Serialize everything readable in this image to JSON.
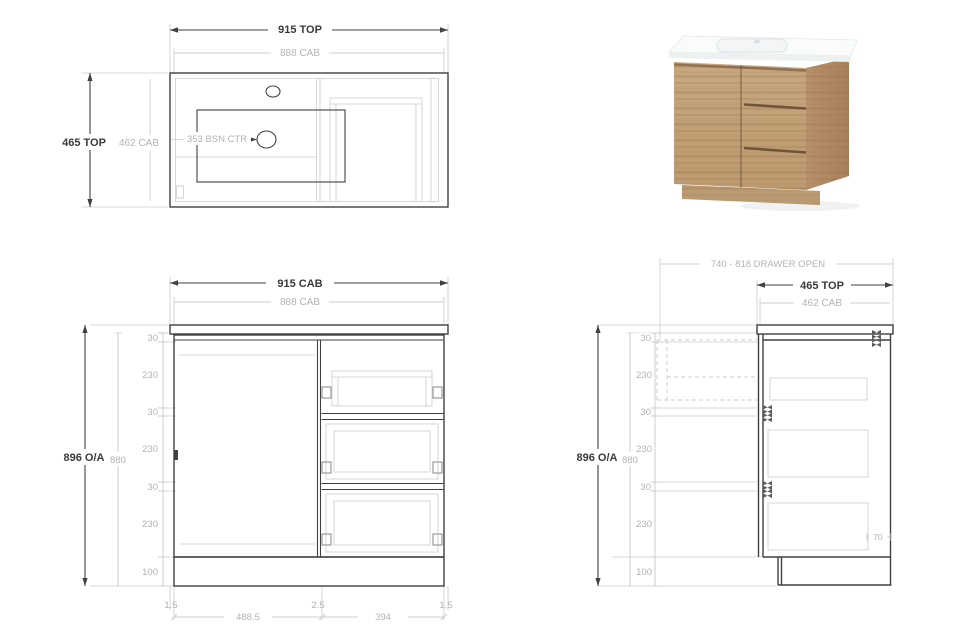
{
  "colors": {
    "line-dark": "#404040",
    "line-gray": "#cccccc",
    "text-dark": "#3a3a3a",
    "text-gray": "#b3b3b3",
    "wood": "#c8a77e",
    "wood-side": "#b18a62",
    "wood-groove": "#6f543a",
    "ceramic": "#fafbfb"
  },
  "top_view": {
    "width_top": "915 TOP",
    "width_cab": "888 CAB",
    "depth_top": "465 TOP",
    "depth_cab": "462 CAB",
    "basin_centre": "353 BSN CTR"
  },
  "front_view": {
    "width_cab": "915 CAB",
    "width_inner": "888 CAB",
    "height_overall": "896 O/A",
    "height_cab": "880",
    "v_segments": [
      "30",
      "230",
      "30",
      "230",
      "30",
      "230",
      "100"
    ],
    "bottom_segments": [
      "1.5",
      "488.5",
      "2.5",
      "394",
      "1.5"
    ]
  },
  "side_view": {
    "drawer_open": "740 - 818 DRAWER OPEN",
    "depth_top": "465 TOP",
    "depth_cab": "462 CAB",
    "height_overall": "896 O/A",
    "height_cab": "880",
    "v_segments": [
      "30",
      "230",
      "30",
      "230",
      "30",
      "230",
      "100"
    ],
    "back_gap": "70"
  }
}
